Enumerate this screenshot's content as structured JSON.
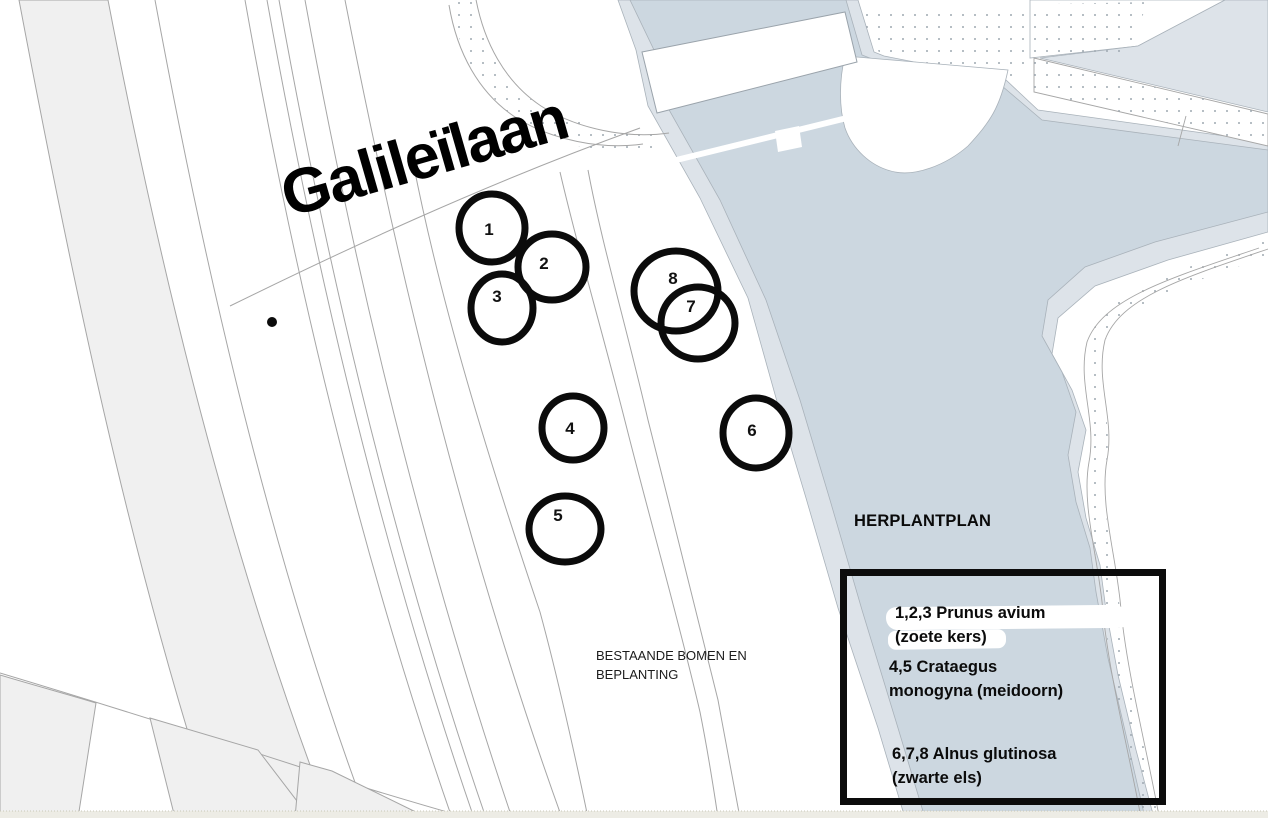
{
  "street_label": "Galileïlaan",
  "annotations": {
    "existing_area_line1": "BESTAANDE BOMEN EN",
    "existing_area_line2": "BEPLANTING",
    "plan_heading": "HERPLANTPLAN"
  },
  "legend": {
    "entries": [
      {
        "line1": "1,2,3 Prunus avium",
        "line2": "(zoete kers)"
      },
      {
        "line1": "4,5 Crataegus",
        "line2": "monogyna (meidoorn)"
      },
      {
        "line1": "6,7,8 Alnus glutinosa",
        "line2": "(zwarte els)"
      }
    ]
  },
  "markers": [
    {
      "label": "1",
      "cx": 492,
      "cy": 228
    },
    {
      "label": "2",
      "cx": 552,
      "cy": 267
    },
    {
      "label": "3",
      "cx": 502,
      "cy": 308
    },
    {
      "label": "4",
      "cx": 573,
      "cy": 428
    },
    {
      "label": "5",
      "cx": 565,
      "cy": 529
    },
    {
      "label": "6",
      "cx": 756,
      "cy": 433
    },
    {
      "label": "7",
      "cx": 698,
      "cy": 323
    },
    {
      "label": "8",
      "cx": 676,
      "cy": 291
    }
  ],
  "colors": {
    "water": "#ccd7e0",
    "shore_band": "#dde3e9",
    "parcel_fill": "#f0f0f0",
    "boundary_line": "#a6a6a6",
    "marker_outline": "#0b0b0b",
    "bottom_strip": "#edece5"
  }
}
